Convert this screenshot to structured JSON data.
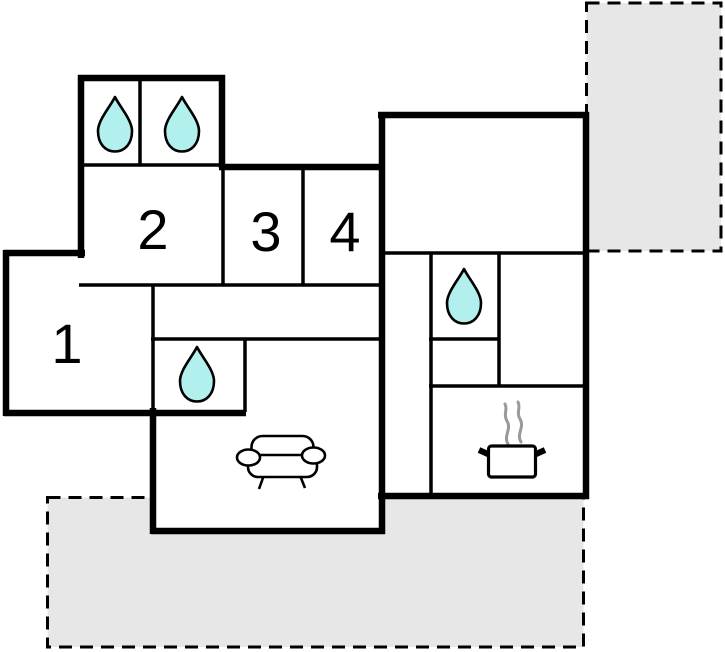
{
  "plan": {
    "canvas": {
      "width": 725,
      "height": 652,
      "background": "#ffffff"
    },
    "colors": {
      "wall": "#000000",
      "terrace_fill": "#e7e7e7",
      "terrace_border": "#000000",
      "floor_fill": "#ffffff",
      "water_drop_fill": "#b2f0ee",
      "water_drop_stroke": "#000000",
      "furniture_stroke": "#000000",
      "steam": "#999999",
      "label_color": "#000000"
    },
    "label_font_size": 56,
    "terraces": [
      {
        "name": "terrace-top-right",
        "x": 586.5,
        "y": 3,
        "w": 134.5,
        "h": 248
      },
      {
        "name": "terrace-bottom",
        "x": 47.5,
        "y": 497.5,
        "w": 536,
        "h": 149.5
      }
    ],
    "floor_areas": [
      {
        "name": "bath-block-floor",
        "x": 79,
        "y": 75,
        "w": 146,
        "h": 92
      },
      {
        "name": "bedroom-band-floor",
        "x": 79,
        "y": 165,
        "w": 305,
        "h": 122
      },
      {
        "name": "room1-floor",
        "x": 4,
        "y": 250,
        "w": 152,
        "h": 166
      },
      {
        "name": "living-hall-floor",
        "x": 151,
        "y": 284,
        "w": 233,
        "h": 250
      },
      {
        "name": "right-wing-floor",
        "x": 378,
        "y": 112,
        "w": 211,
        "h": 386
      }
    ],
    "walls": {
      "thick_width": 6.5,
      "thin_width": 3.5,
      "thick": [
        {
          "x1": 78,
          "y1": 78,
          "x2": 225,
          "y2": 78
        },
        {
          "x1": 81,
          "y1": 75,
          "x2": 81,
          "y2": 258
        },
        {
          "x1": 222,
          "y1": 75,
          "x2": 222,
          "y2": 168
        },
        {
          "x1": 219,
          "y1": 167,
          "x2": 384,
          "y2": 167
        },
        {
          "x1": 382,
          "y1": 112,
          "x2": 382,
          "y2": 534
        },
        {
          "x1": 378,
          "y1": 115,
          "x2": 589,
          "y2": 115
        },
        {
          "x1": 586,
          "y1": 112,
          "x2": 586,
          "y2": 499
        },
        {
          "x1": 378,
          "y1": 496,
          "x2": 589,
          "y2": 496
        },
        {
          "x1": 151,
          "y1": 531,
          "x2": 385,
          "y2": 531
        },
        {
          "x1": 153,
          "y1": 408,
          "x2": 153,
          "y2": 534
        },
        {
          "x1": 4,
          "y1": 413,
          "x2": 246,
          "y2": 413
        },
        {
          "x1": 6,
          "y1": 250,
          "x2": 6,
          "y2": 416
        },
        {
          "x1": 4,
          "y1": 253,
          "x2": 85,
          "y2": 253
        }
      ],
      "thin": [
        {
          "x1": 79,
          "y1": 165,
          "x2": 223,
          "y2": 165
        },
        {
          "x1": 140,
          "y1": 78,
          "x2": 140,
          "y2": 165
        },
        {
          "x1": 79,
          "y1": 285,
          "x2": 382,
          "y2": 285
        },
        {
          "x1": 223,
          "y1": 165,
          "x2": 223,
          "y2": 286
        },
        {
          "x1": 303,
          "y1": 167,
          "x2": 303,
          "y2": 286
        },
        {
          "x1": 153,
          "y1": 284,
          "x2": 153,
          "y2": 412
        },
        {
          "x1": 151,
          "y1": 339,
          "x2": 382,
          "y2": 339
        },
        {
          "x1": 245,
          "y1": 339,
          "x2": 245,
          "y2": 412
        },
        {
          "x1": 382,
          "y1": 253,
          "x2": 586,
          "y2": 253
        },
        {
          "x1": 431,
          "y1": 253,
          "x2": 431,
          "y2": 496
        },
        {
          "x1": 499,
          "y1": 253,
          "x2": 499,
          "y2": 387
        },
        {
          "x1": 429,
          "y1": 339,
          "x2": 500,
          "y2": 339
        },
        {
          "x1": 429,
          "y1": 386,
          "x2": 586,
          "y2": 386
        }
      ]
    },
    "rooms": [
      {
        "label": "1",
        "x": 67,
        "y": 363
      },
      {
        "label": "2",
        "x": 153,
        "y": 249
      },
      {
        "label": "3",
        "x": 266,
        "y": 251
      },
      {
        "label": "4",
        "x": 345,
        "y": 251
      }
    ],
    "fixtures": {
      "water_drops": [
        {
          "name": "water-drop-top-left",
          "x": 115,
          "y": 124
        },
        {
          "name": "water-drop-top-right",
          "x": 182,
          "y": 124
        },
        {
          "name": "water-drop-hall",
          "x": 197,
          "y": 374
        },
        {
          "name": "water-drop-right",
          "x": 464,
          "y": 296
        }
      ],
      "sofa": {
        "x": 282,
        "y": 463
      },
      "stove": {
        "x": 512,
        "y": 461
      }
    }
  }
}
